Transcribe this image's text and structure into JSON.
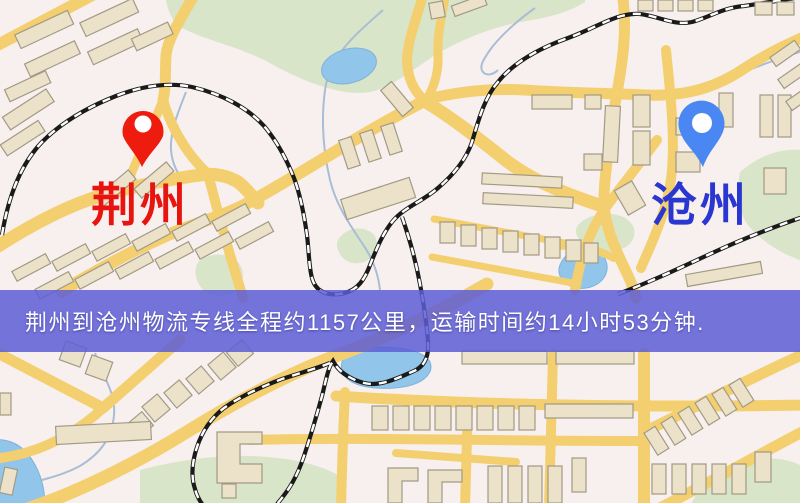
{
  "origin": {
    "label": "荆州",
    "label_color": "#e81410",
    "pin_color": "#ee1c0f"
  },
  "destination": {
    "label": "沧州",
    "label_color": "#2a36d0",
    "pin_color": "#4b87f2"
  },
  "banner": {
    "text": "荆州到沧州物流专线全程约1157公里，运输时间约14小时53分钟.",
    "distance_text": "约1157公里",
    "duration_text": "约14小时53分钟",
    "background_color": "#5d5dd6",
    "text_color": "#ffffff"
  },
  "palette": {
    "map_background": "#f8f0ee",
    "road": "#f4cf70",
    "building_fill": "#ebe2c9",
    "building_stroke": "#a29a85",
    "park": "#d8e5c8",
    "water": "#92c5ea",
    "railway": "#1a1a1a"
  }
}
